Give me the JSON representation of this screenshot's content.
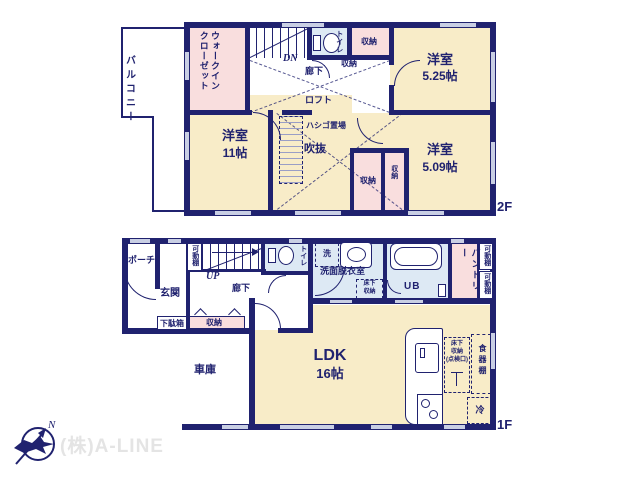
{
  "colors": {
    "wall": "#20226f",
    "cream": "#f8ecc8",
    "pink": "#f9dede",
    "blue": "#dde9f4",
    "win": "#c9cfe4",
    "logo_text": "#e4e4e4",
    "bg": "#ffffff"
  },
  "logo": {
    "company": "(株)A-LINE",
    "north": "N"
  },
  "floor2": {
    "label": "2F",
    "balcony": "バルコニー",
    "wic": "ウォークインクローゼット",
    "dn": "DN",
    "hall": "廊下",
    "hall_storage": "収納",
    "toilet": "トイレ",
    "storage_top": "収納",
    "room_a": {
      "name": "洋室",
      "size": "5.25帖"
    },
    "loft": "ロフト",
    "ladder": "ハシゴ置場",
    "void": "吹抜",
    "room_b": {
      "name": "洋室",
      "size": "11帖"
    },
    "storage_1": "収納",
    "storage_2": "収納",
    "room_c": {
      "name": "洋室",
      "size": "5.09帖"
    }
  },
  "floor1": {
    "label": "1F",
    "porch": "ポーチ",
    "entrance": "玄関",
    "shoe_cabinet": "下駄箱",
    "shelf": "可動棚",
    "up": "UP",
    "hall": "廊下",
    "hall_storage": "収納",
    "toilet": "トイレ",
    "laundry": "洗",
    "washroom": "洗面脱衣室",
    "underfloor_1": "床下",
    "underfloor_2": "収納",
    "bath": "UB",
    "pantry": "パントリー",
    "shelf_r1": "可動棚",
    "shelf_r2": "可動棚",
    "ldk": {
      "name": "LDK",
      "size": "16帖"
    },
    "kitchen_underfloor_1": "床下",
    "kitchen_underfloor_2": "収納",
    "kitchen_underfloor_3": "(点検口)",
    "cupboard": "食器棚",
    "fridge": "冷",
    "garage": "車庫"
  }
}
